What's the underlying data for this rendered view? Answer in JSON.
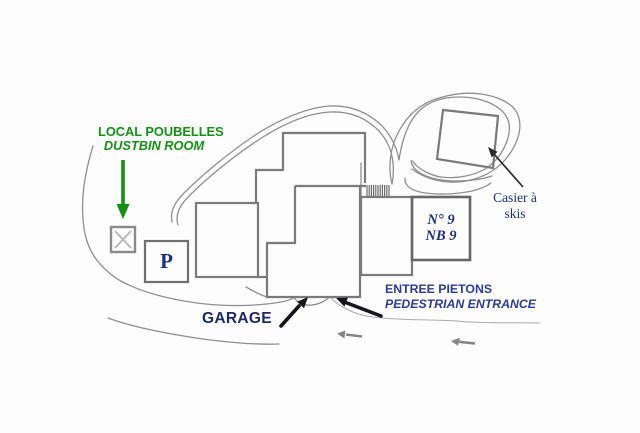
{
  "site_plan": {
    "dustbin_room": {
      "label_fr": "LOCAL POUBELLES",
      "label_en": "DUSTBIN ROOM",
      "box_mark": "x"
    },
    "parking": {
      "label": "P"
    },
    "residence": {
      "number_fr": "N° 9",
      "number_en": "NB 9"
    },
    "ski_locker": {
      "label_line1": "Casier à",
      "label_line2": "skis"
    },
    "garage": {
      "label": "GARAGE"
    },
    "pedestrian_entrance": {
      "label_fr": "ENTREE PIETONS",
      "label_en": "PEDESTRIAN ENTRANCE"
    }
  },
  "icons": {
    "dustbin_pointer": "green-down-arrow",
    "garage_pointer": "black-up-right-arrow",
    "entrance_pointer": "black-up-left-arrow",
    "ski_locker_pointer": "black-up-left-arrow",
    "traffic_direction": "gray-left-arrow"
  },
  "colors": {
    "label_green": "#129112",
    "label_navy": "#2c3c94",
    "label_dark_navy": "#1d2960",
    "label_serif_navy": "#1c2f7e",
    "drawing_gray": "#7a7a7a",
    "road_gray": "#8f8f8f",
    "arrow_black": "#15151a"
  }
}
